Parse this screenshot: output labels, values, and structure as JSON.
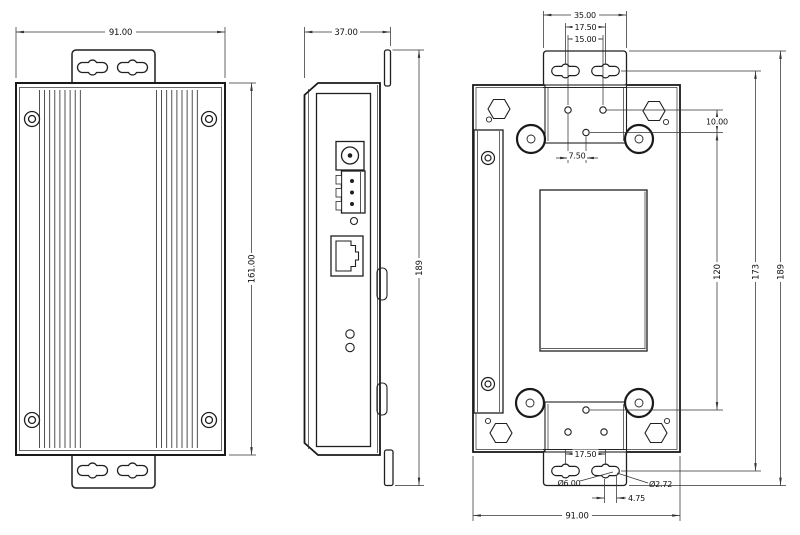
{
  "views": {
    "front": {
      "dim_width": "91.00",
      "dim_height": "161.00"
    },
    "side": {
      "dim_width": "37.00",
      "dim_height": "189"
    },
    "back": {
      "dim_bracket_width": "35.00",
      "dim_slot_spacing_top": "17.50",
      "dim_hole_spacing": "15.00",
      "dim_hole_offset_vertical": "10.00",
      "dim_hole_offset_horizontal": "7.50",
      "dim_hole_span": "120",
      "dim_slot_span": "173",
      "dim_overall_height": "189",
      "dim_slot_spacing_bottom": "17.50",
      "dim_slot_diameter": "Ø6.00",
      "dim_hole_diameter": "Ø2.72",
      "dim_slot_end_offset": "4.75",
      "dim_overall_width": "91.00"
    }
  }
}
